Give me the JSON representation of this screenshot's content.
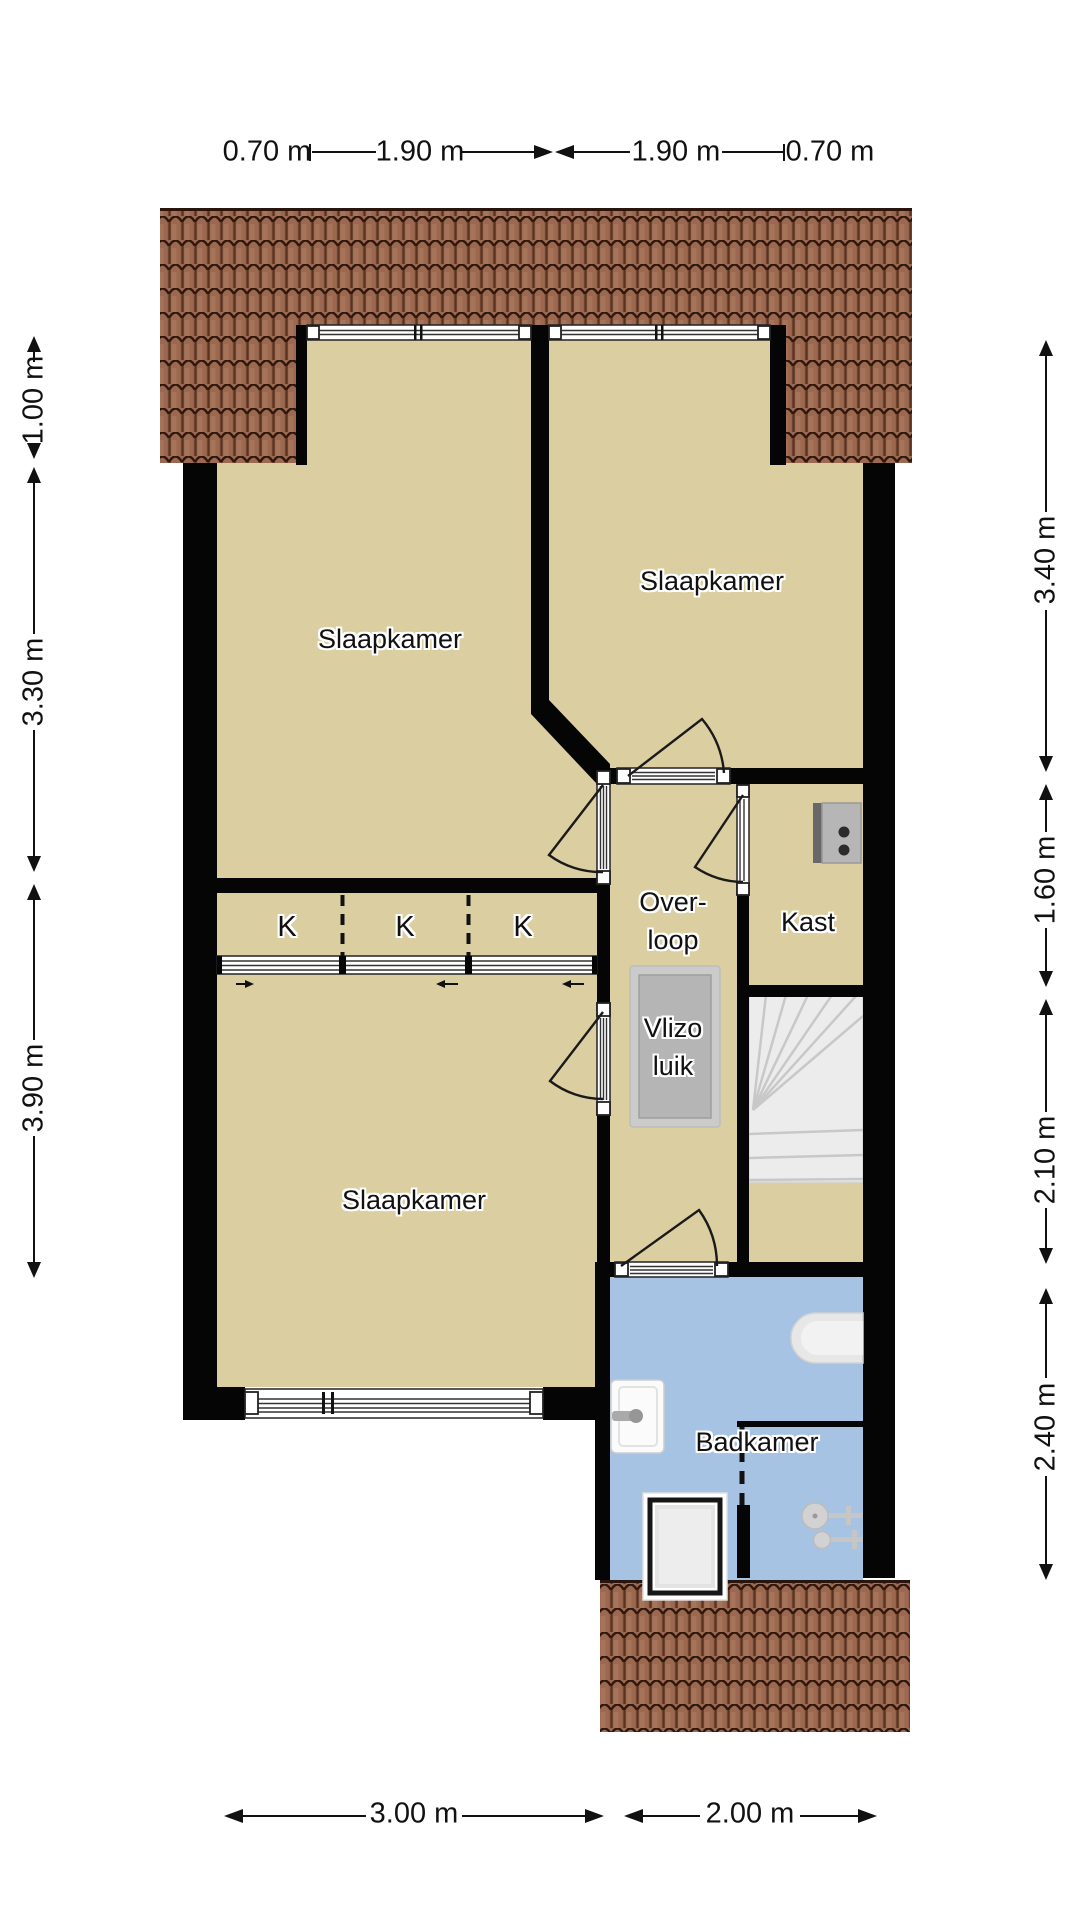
{
  "rooms": {
    "bedroom_top_left": "Slaapkamer",
    "bedroom_top_right": "Slaapkamer",
    "bedroom_bottom": "Slaapkamer",
    "landing_line1": "Over-",
    "landing_line2": "loop",
    "closet": "Kast",
    "attic_hatch_line1": "Vlizo",
    "attic_hatch_line2": "luik",
    "bathroom": "Badkamer",
    "closet_marker_1": "K",
    "closet_marker_2": "K",
    "closet_marker_3": "K"
  },
  "dimensions": {
    "top": {
      "left_outer": "0.70 m",
      "left_inner": "1.90 m",
      "right_inner": "1.90 m",
      "right_outer": "0.70 m"
    },
    "left": {
      "upper": "1.00 m",
      "middle": "3.30 m",
      "lower": "3.90 m"
    },
    "right": {
      "first": "3.40 m",
      "second": "1.60 m",
      "third": "2.10 m",
      "fourth": "2.40 m"
    },
    "bottom": {
      "left": "3.00 m",
      "right": "2.00 m"
    }
  },
  "fixtures": {
    "stairs": "winder-staircase",
    "attic_hatch": "vlizo-hatch-panel",
    "electrical_panel": "meter-cabinet-panel",
    "bathtub": "bathtub",
    "sink": "washbasin",
    "shower": "shower-cabin",
    "shower_fixture": "shower-mixer-tap",
    "closet_sliding_doors": "sliding-door-track"
  },
  "colors": {
    "floor": "#dbcea0",
    "bathroom_floor": "#a6c3e3",
    "roof": "#9c6950",
    "wall": "#050505",
    "stairs": "#ececec",
    "fixture_gray": "#cdcdcd"
  }
}
